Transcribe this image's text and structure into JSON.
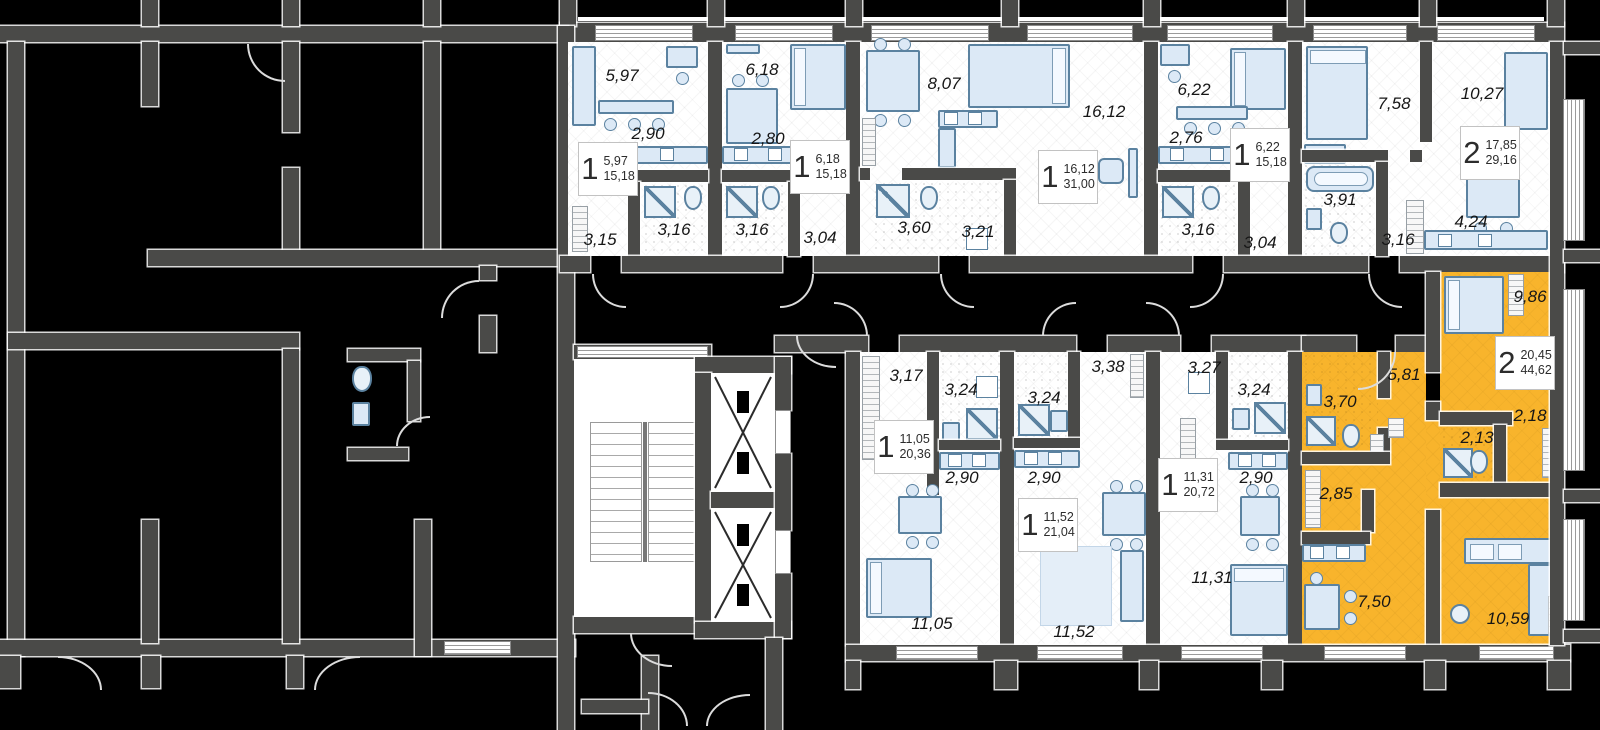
{
  "colors": {
    "highlight": "#F8B42C",
    "wall": "#4A4A48",
    "furniture_fill": "#DCE9F6",
    "furniture_stroke": "#5B82A0",
    "background": "#000000"
  },
  "apartments": [
    {
      "rooms": "1",
      "living_area": "5,97",
      "total_area": "15,18"
    },
    {
      "rooms": "1",
      "living_area": "6,18",
      "total_area": "15,18"
    },
    {
      "rooms": "1",
      "living_area": "16,12",
      "total_area": "31,00"
    },
    {
      "rooms": "1",
      "living_area": "6,22",
      "total_area": "15,18"
    },
    {
      "rooms": "2",
      "living_area": "17,85",
      "total_area": "29,16"
    },
    {
      "rooms": "1",
      "living_area": "11,05",
      "total_area": "20,36"
    },
    {
      "rooms": "1",
      "living_area": "11,52",
      "total_area": "21,04"
    },
    {
      "rooms": "1",
      "living_area": "11,31",
      "total_area": "20,72"
    },
    {
      "rooms": "2",
      "living_area": "20,45",
      "total_area": "44,62"
    }
  ],
  "room_labels": [
    {
      "text": "5,97"
    },
    {
      "text": "2,90"
    },
    {
      "text": "3,16"
    },
    {
      "text": "3,15"
    },
    {
      "text": "6,18"
    },
    {
      "text": "2,80"
    },
    {
      "text": "3,16"
    },
    {
      "text": "3,04"
    },
    {
      "text": "8,07"
    },
    {
      "text": "16,12"
    },
    {
      "text": "3,60"
    },
    {
      "text": "3,21"
    },
    {
      "text": "6,22"
    },
    {
      "text": "2,76"
    },
    {
      "text": "3,16"
    },
    {
      "text": "3,04"
    },
    {
      "text": "7,58"
    },
    {
      "text": "10,27"
    },
    {
      "text": "3,91"
    },
    {
      "text": "3,16"
    },
    {
      "text": "4,24"
    },
    {
      "text": "3,17"
    },
    {
      "text": "3,24"
    },
    {
      "text": "2,90"
    },
    {
      "text": "11,05"
    },
    {
      "text": "3,24"
    },
    {
      "text": "3,38"
    },
    {
      "text": "2,90"
    },
    {
      "text": "11,52"
    },
    {
      "text": "3,27"
    },
    {
      "text": "3,24"
    },
    {
      "text": "2,90"
    },
    {
      "text": "11,31"
    },
    {
      "text": "9,86"
    },
    {
      "text": "5,81"
    },
    {
      "text": "3,70"
    },
    {
      "text": "2,85"
    },
    {
      "text": "2,13"
    },
    {
      "text": "2,18"
    },
    {
      "text": "7,50"
    },
    {
      "text": "10,59"
    }
  ]
}
